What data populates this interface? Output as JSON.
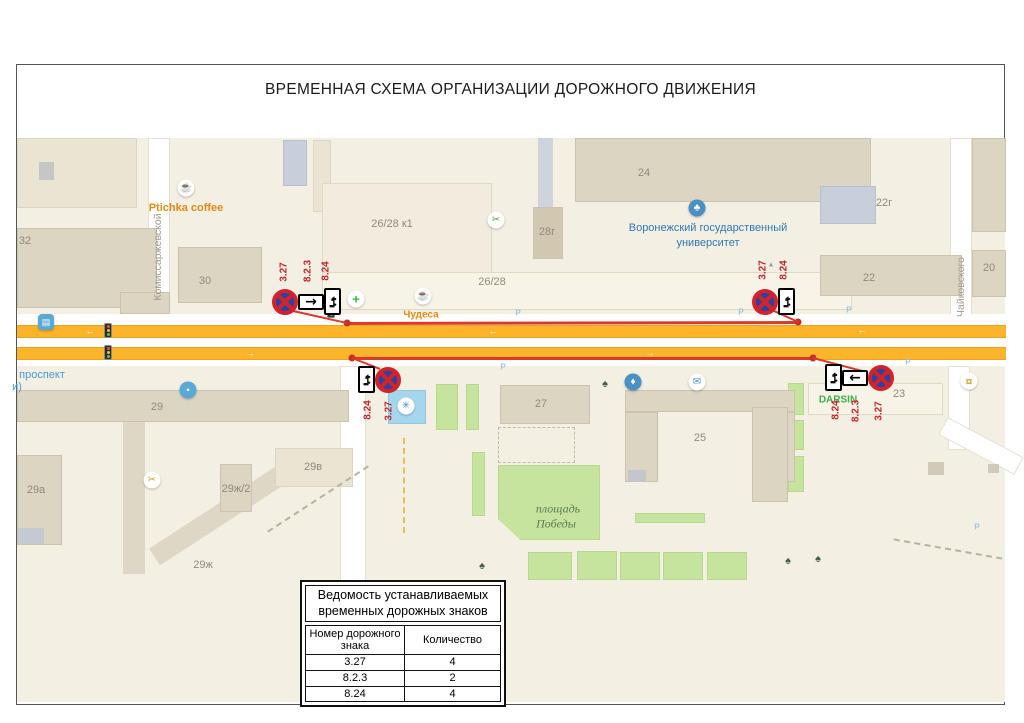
{
  "title": "ВРЕМЕННАЯ СХЕМА ОРГАНИЗАЦИИ ДОРОЖНОГО ДВИЖЕНИЯ",
  "colors": {
    "line_red": "#d93a2b",
    "road_orange": "#fdb32a",
    "sign_blue": "#2743a6",
    "sign_red": "#d2232a"
  },
  "map": {
    "labels": [
      {
        "t": "Комиссаржевской",
        "x": 158,
        "y": 257,
        "cls": "street",
        "rot": 1,
        "name": "street-label-komissarzhevskoy"
      },
      {
        "t": "Чайковского",
        "x": 961,
        "y": 287,
        "cls": "street",
        "rot": 1,
        "name": "street-label-chaykovskogo"
      },
      {
        "t": "проспект",
        "x": 42,
        "y": 375,
        "cls": "avenue",
        "name": "street-label-prospekt"
      },
      {
        "t": "и)",
        "x": 17,
        "y": 387,
        "cls": "avenue",
        "name": "street-label-prospekt-2"
      },
      {
        "t": "Ptichka coffee",
        "x": 186,
        "y": 208,
        "cls": "poi-orange",
        "name": "poi-label-ptichka-coffee"
      },
      {
        "t": "Чудеса",
        "x": 421,
        "y": 315,
        "cls": "poi-orange sm",
        "name": "poi-label-chudesa"
      },
      {
        "t": "Воронежский государственный",
        "x": 708,
        "y": 228,
        "cls": "poi-blue",
        "name": "poi-label-university-1"
      },
      {
        "t": "университет",
        "x": 708,
        "y": 243,
        "cls": "poi-blue",
        "name": "poi-label-university-2"
      },
      {
        "t": "площадь",
        "x": 558,
        "y": 509,
        "cls": "park",
        "name": "park-label-1"
      },
      {
        "t": "Победы",
        "x": 556,
        "y": 524,
        "cls": "park",
        "name": "park-label-2"
      },
      {
        "t": "DARSIN",
        "x": 838,
        "y": 400,
        "cls": "poi-green",
        "name": "poi-label-darsin"
      },
      {
        "t": "32",
        "x": 25,
        "y": 241,
        "cls": "bnum",
        "name": "building-number"
      },
      {
        "t": "30",
        "x": 205,
        "y": 281,
        "cls": "bnum",
        "name": "building-number"
      },
      {
        "t": "26/28 к1",
        "x": 392,
        "y": 224,
        "cls": "bnum",
        "name": "building-number"
      },
      {
        "t": "26/28",
        "x": 492,
        "y": 282,
        "cls": "bnum",
        "name": "building-number"
      },
      {
        "t": "28г",
        "x": 547,
        "y": 232,
        "cls": "bnum",
        "name": "building-number"
      },
      {
        "t": "24",
        "x": 644,
        "y": 173,
        "cls": "bnum",
        "name": "building-number"
      },
      {
        "t": "22г",
        "x": 884,
        "y": 203,
        "cls": "bnum",
        "name": "building-number"
      },
      {
        "t": "22",
        "x": 869,
        "y": 278,
        "cls": "bnum",
        "name": "building-number"
      },
      {
        "t": "20",
        "x": 989,
        "y": 268,
        "cls": "bnum",
        "name": "building-number"
      },
      {
        "t": "29",
        "x": 157,
        "y": 407,
        "cls": "bnum",
        "name": "building-number"
      },
      {
        "t": "27",
        "x": 541,
        "y": 404,
        "cls": "bnum",
        "name": "building-number"
      },
      {
        "t": "25",
        "x": 700,
        "y": 438,
        "cls": "bnum",
        "name": "building-number"
      },
      {
        "t": "23",
        "x": 899,
        "y": 394,
        "cls": "bnum",
        "name": "building-number"
      },
      {
        "t": "29а",
        "x": 36,
        "y": 490,
        "cls": "bnum",
        "name": "building-number"
      },
      {
        "t": "29в",
        "x": 313,
        "y": 467,
        "cls": "bnum",
        "name": "building-number"
      },
      {
        "t": "29ж/2",
        "x": 236,
        "y": 489,
        "cls": "bnum",
        "name": "building-number"
      },
      {
        "t": "29ж",
        "x": 203,
        "y": 565,
        "cls": "bnum",
        "name": "building-number"
      },
      {
        "t": "P",
        "x": 518,
        "y": 313,
        "cls": "pk",
        "name": "parking-marker"
      },
      {
        "t": "P",
        "x": 741,
        "y": 312,
        "cls": "pk",
        "name": "parking-marker"
      },
      {
        "t": "P",
        "x": 849,
        "y": 310,
        "cls": "pk",
        "name": "parking-marker"
      },
      {
        "t": "P",
        "x": 908,
        "y": 362,
        "cls": "pk",
        "name": "parking-marker"
      },
      {
        "t": "P",
        "x": 503,
        "y": 367,
        "cls": "pk",
        "name": "parking-marker"
      },
      {
        "t": "P",
        "x": 977,
        "y": 527,
        "cls": "pk",
        "name": "parking-marker"
      },
      {
        "t": "←",
        "x": 90,
        "y": 331,
        "cls": "roadarrow",
        "name": "road-direction-arrow"
      },
      {
        "t": "←",
        "x": 493,
        "y": 331,
        "cls": "roadarrow",
        "name": "road-direction-arrow"
      },
      {
        "t": "←",
        "x": 862,
        "y": 330,
        "cls": "roadarrow",
        "name": "road-direction-arrow"
      },
      {
        "t": "→",
        "x": 250,
        "y": 353,
        "cls": "roadarrow",
        "name": "road-direction-arrow"
      },
      {
        "t": "→",
        "x": 650,
        "y": 353,
        "cls": "roadarrow",
        "name": "road-direction-arrow"
      },
      {
        "t": "▴",
        "x": 771,
        "y": 264,
        "cls": "tiny",
        "name": "monument-icon"
      }
    ],
    "icons": [
      {
        "n": "coffee-icon",
        "x": 186,
        "y": 188,
        "g": "☕",
        "fg": "#c8781e"
      },
      {
        "n": "pharmacy-icon",
        "x": 356,
        "y": 299,
        "g": "+",
        "fg": "#3bb144",
        "fs": 13,
        "b": 1
      },
      {
        "n": "coffee-icon",
        "x": 423,
        "y": 296,
        "g": "☕",
        "fg": "#c8781e"
      },
      {
        "n": "scissors-icon",
        "x": 496,
        "y": 220,
        "g": "✂",
        "fg": "#58a83c"
      },
      {
        "n": "university-icon",
        "x": 697,
        "y": 208,
        "g": "♣",
        "fg": "#ffffff",
        "bg": "#4a90c4"
      },
      {
        "n": "fountain-icon",
        "x": 406,
        "y": 406,
        "g": "✳",
        "fg": "#4a90c4"
      },
      {
        "n": "water-icon",
        "x": 633,
        "y": 382,
        "g": "♦",
        "fg": "#ffffff",
        "bg": "#4a90c4"
      },
      {
        "n": "mail-icon",
        "x": 697,
        "y": 382,
        "g": "✉",
        "fg": "#4a90c4"
      },
      {
        "n": "shop-icon",
        "x": 969,
        "y": 381,
        "g": "¤",
        "fg": "#d9a93c",
        "fs": 12,
        "b": 1
      },
      {
        "n": "beauty-icon",
        "x": 152,
        "y": 480,
        "g": "✂",
        "fg": "#cba52e"
      },
      {
        "n": "pin-icon",
        "x": 188,
        "y": 390,
        "g": "●",
        "fg": "#ffffff",
        "bg": "#58a8d8",
        "fs": 6
      },
      {
        "n": "bus-stop-icon",
        "x": 46,
        "y": 322,
        "g": "▤",
        "fg": "#ffffff",
        "bg": "#58a8d8",
        "sq": 1,
        "fs": 9
      },
      {
        "n": "tree-icon",
        "x": 605,
        "y": 384,
        "g": "♠",
        "fg": "#44603f",
        "plain": 1
      },
      {
        "n": "tree-icon",
        "x": 482,
        "y": 566,
        "g": "♠",
        "fg": "#44603f",
        "plain": 1
      },
      {
        "n": "tree-icon",
        "x": 788,
        "y": 561,
        "g": "♠",
        "fg": "#44603f",
        "plain": 1
      },
      {
        "n": "tree-icon",
        "x": 818,
        "y": 559,
        "g": "♠",
        "fg": "#44603f",
        "plain": 1
      }
    ]
  },
  "signs": {
    "groups": [
      {
        "x": 272,
        "y": 288,
        "items": [
          "sign327",
          "arrowR",
          "tow"
        ],
        "labels": [
          {
            "t": "3.27",
            "x": 284,
            "y": 272
          },
          {
            "t": "8.2.3",
            "x": 308,
            "y": 271
          },
          {
            "t": "8.24",
            "x": 326,
            "y": 271
          }
        ]
      },
      {
        "x": 752,
        "y": 288,
        "items": [
          "sign327",
          "tow"
        ],
        "labels": [
          {
            "t": "3.27",
            "x": 763,
            "y": 270
          },
          {
            "t": "8.24",
            "x": 784,
            "y": 270
          }
        ]
      },
      {
        "x": 358,
        "y": 366,
        "items": [
          "tow",
          "sign327"
        ],
        "labels": [
          {
            "t": "8.24",
            "x": 368,
            "y": 410
          },
          {
            "t": "3.27",
            "x": 389,
            "y": 411
          }
        ]
      },
      {
        "x": 825,
        "y": 364,
        "items": [
          "tow",
          "arrowL",
          "sign327"
        ],
        "labels": [
          {
            "t": "8.24",
            "x": 836,
            "y": 410
          },
          {
            "t": "8.2.3",
            "x": 856,
            "y": 411
          },
          {
            "t": "3.27",
            "x": 879,
            "y": 411
          }
        ]
      }
    ]
  },
  "red_lines": [
    {
      "x1": 347,
      "y1": 323,
      "x2": 798,
      "y2": 322,
      "w": 3,
      "d1": 1,
      "d2": 1
    },
    {
      "x1": 352,
      "y1": 358,
      "x2": 813,
      "y2": 358,
      "w": 3,
      "d1": 1,
      "d2": 1
    },
    {
      "x1": 293,
      "y1": 311,
      "x2": 347,
      "y2": 323,
      "w": 2
    },
    {
      "x1": 772,
      "y1": 310,
      "x2": 798,
      "y2": 322,
      "w": 2
    },
    {
      "x1": 352,
      "y1": 358,
      "x2": 380,
      "y2": 369,
      "w": 2
    },
    {
      "x1": 813,
      "y1": 358,
      "x2": 866,
      "y2": 372,
      "w": 2
    }
  ],
  "legend": {
    "title_line1": "Ведомость устанавливаемых",
    "title_line2": "временных дорожных знаков",
    "col1": "Номер дорожного знака",
    "col2": "Количество",
    "rows": [
      [
        "3.27",
        "4"
      ],
      [
        "8.2.3",
        "2"
      ],
      [
        "8.24",
        "4"
      ]
    ]
  }
}
